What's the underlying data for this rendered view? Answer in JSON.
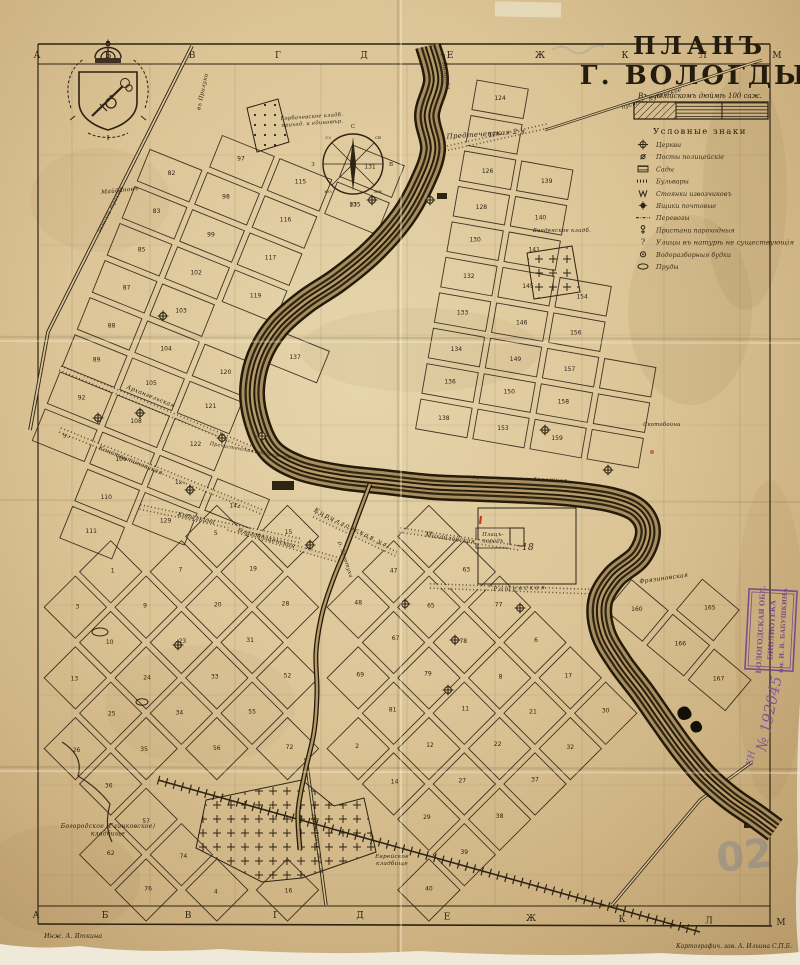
{
  "title": {
    "line1": "ПЛАНЪ",
    "line2": "Г. ВОЛОГДЫ.",
    "scale_caption": "Въ англійскомъ дюймѣ 100 саж."
  },
  "legend": {
    "heading": "Условные знаки",
    "items": [
      {
        "symbol": "church-icon",
        "label": "Церкви"
      },
      {
        "symbol": "police-icon",
        "label": "Посты полицейскіе"
      },
      {
        "symbol": "garden-icon",
        "label": "Сады"
      },
      {
        "symbol": "boulevard-icon",
        "label": "Бульвары"
      },
      {
        "symbol": "cab-icon",
        "label": "Стоянки извозчиковъ"
      },
      {
        "symbol": "postbox-icon",
        "label": "Ящики почтовые"
      },
      {
        "symbol": "ferry-icon",
        "label": "Перевозы"
      },
      {
        "symbol": "pier-icon",
        "label": "Пристани пароходныя"
      },
      {
        "symbol": "question-icon",
        "label": "Улицы въ натурѣ не существующія"
      },
      {
        "symbol": "water-icon",
        "label": "Водоразборныя будки"
      },
      {
        "symbol": "pond-icon",
        "label": "Пруды"
      }
    ]
  },
  "border": {
    "letters_top": [
      "А",
      "Б",
      "В",
      "Г",
      "Д",
      "Е",
      "Ж",
      "К",
      "Л",
      "М"
    ],
    "letters_bottom": [
      "А",
      "Б",
      "В",
      "Г",
      "Д",
      "Е",
      "Ж",
      "К",
      "Л",
      "М"
    ]
  },
  "compass": {
    "points": [
      "С",
      "СВ",
      "В",
      "ЮВ",
      "Ю",
      "ЮЗ",
      "З",
      "СЗ"
    ]
  },
  "map_labels": [
    {
      "id": "predtechenskaya",
      "text": "Предтеченская 2-я"
    },
    {
      "id": "arkhangelskaya",
      "text": "Архангельская"
    },
    {
      "id": "konstantinovskaya",
      "text": "Константиновская"
    },
    {
      "id": "kobylkina",
      "text": "Кобылкина"
    },
    {
      "id": "blagoveshchenskaya",
      "text": "Благовѣщенская"
    },
    {
      "id": "mikhailovskaya",
      "text": "Михайловская"
    },
    {
      "id": "platzparad",
      "text": "Плацъ-",
      "text2": "парадъ"
    },
    {
      "id": "roshchenskaya",
      "text": "Рощенская"
    },
    {
      "id": "kirillovskaya",
      "text": "Кирилловская ул."
    },
    {
      "id": "fryazinovskaya",
      "text": "Фрязиновская"
    },
    {
      "id": "nab_left",
      "text": "Пречистенская набережная"
    },
    {
      "id": "nab_right",
      "text": "Архангельская набережная"
    },
    {
      "id": "skotoboyni",
      "text": "Скотобойни"
    },
    {
      "id": "vvedenskoe",
      "text": "Введенское кладб."
    },
    {
      "id": "gorbachevskoe",
      "text": "Горбачевское кладб.",
      "text2": "приход. и единовѣр."
    },
    {
      "id": "bogorodskoe",
      "text": "Богородское (Глинковское)",
      "text2": "кладбище"
    },
    {
      "id": "evreyskoe",
      "text": "Еврейское",
      "text2": "кладбище"
    },
    {
      "id": "poshekhonskoe",
      "text": "Пошехонск. зем. ш."
    },
    {
      "id": "trakt",
      "text": "земскій трактъ"
    },
    {
      "id": "priluki",
      "text": "въ Прилуки"
    },
    {
      "id": "kubenskoe",
      "text": "пуст. с. Кубенское"
    },
    {
      "id": "maydanov",
      "text": "Майдановъ"
    },
    {
      "id": "r_vologda",
      "text": "р. Вологда"
    },
    {
      "id": "r_zolotukha",
      "text": "р. Золотуха"
    },
    {
      "id": "block18",
      "text": "18"
    }
  ],
  "block_numbers": {
    "north": [
      82,
      83,
      85,
      87,
      88,
      89,
      92,
      93,
      97,
      98,
      99,
      102,
      103,
      104,
      105,
      108,
      109,
      110,
      111,
      115,
      116,
      117,
      119,
      120,
      121,
      122,
      127,
      129,
      131,
      135,
      137,
      142,
      143,
      144,
      147,
      148,
      151,
      152,
      155
    ],
    "east": [
      124,
      125,
      126,
      128,
      130,
      132,
      133,
      134,
      136,
      138,
      139,
      140,
      141,
      145,
      146,
      149,
      150,
      153,
      154,
      156,
      157,
      158,
      159
    ],
    "south": [
      1,
      3,
      5,
      7,
      9,
      10,
      13,
      15,
      19,
      20,
      23,
      24,
      25,
      26,
      28,
      31,
      33,
      34,
      35,
      36,
      44,
      47,
      48,
      52,
      55,
      56,
      57,
      62,
      63,
      65,
      67,
      69,
      72,
      74,
      76,
      77,
      78,
      79,
      81,
      2,
      4,
      6,
      8,
      11,
      12,
      14,
      16,
      17,
      21,
      22,
      27,
      29,
      30,
      32,
      37,
      38,
      39,
      40,
      41,
      42,
      43,
      45,
      46
    ],
    "southeast": [
      160,
      165,
      166,
      167,
      168
    ]
  },
  "stamp": {
    "line1": "ВОЛОГОДСКАЯ ОБЛ.",
    "line2": "БИБЛИОТЕКА",
    "line3": "им. И. В. БАБУШКИНА",
    "acc_prefix": "КН",
    "acc_number": "№ 192045"
  },
  "credits": {
    "left": "Инж. А. Яткина",
    "right": "Картографич. зав. А. Ильина С.П.Б."
  },
  "ghost": {
    "text": "02"
  }
}
